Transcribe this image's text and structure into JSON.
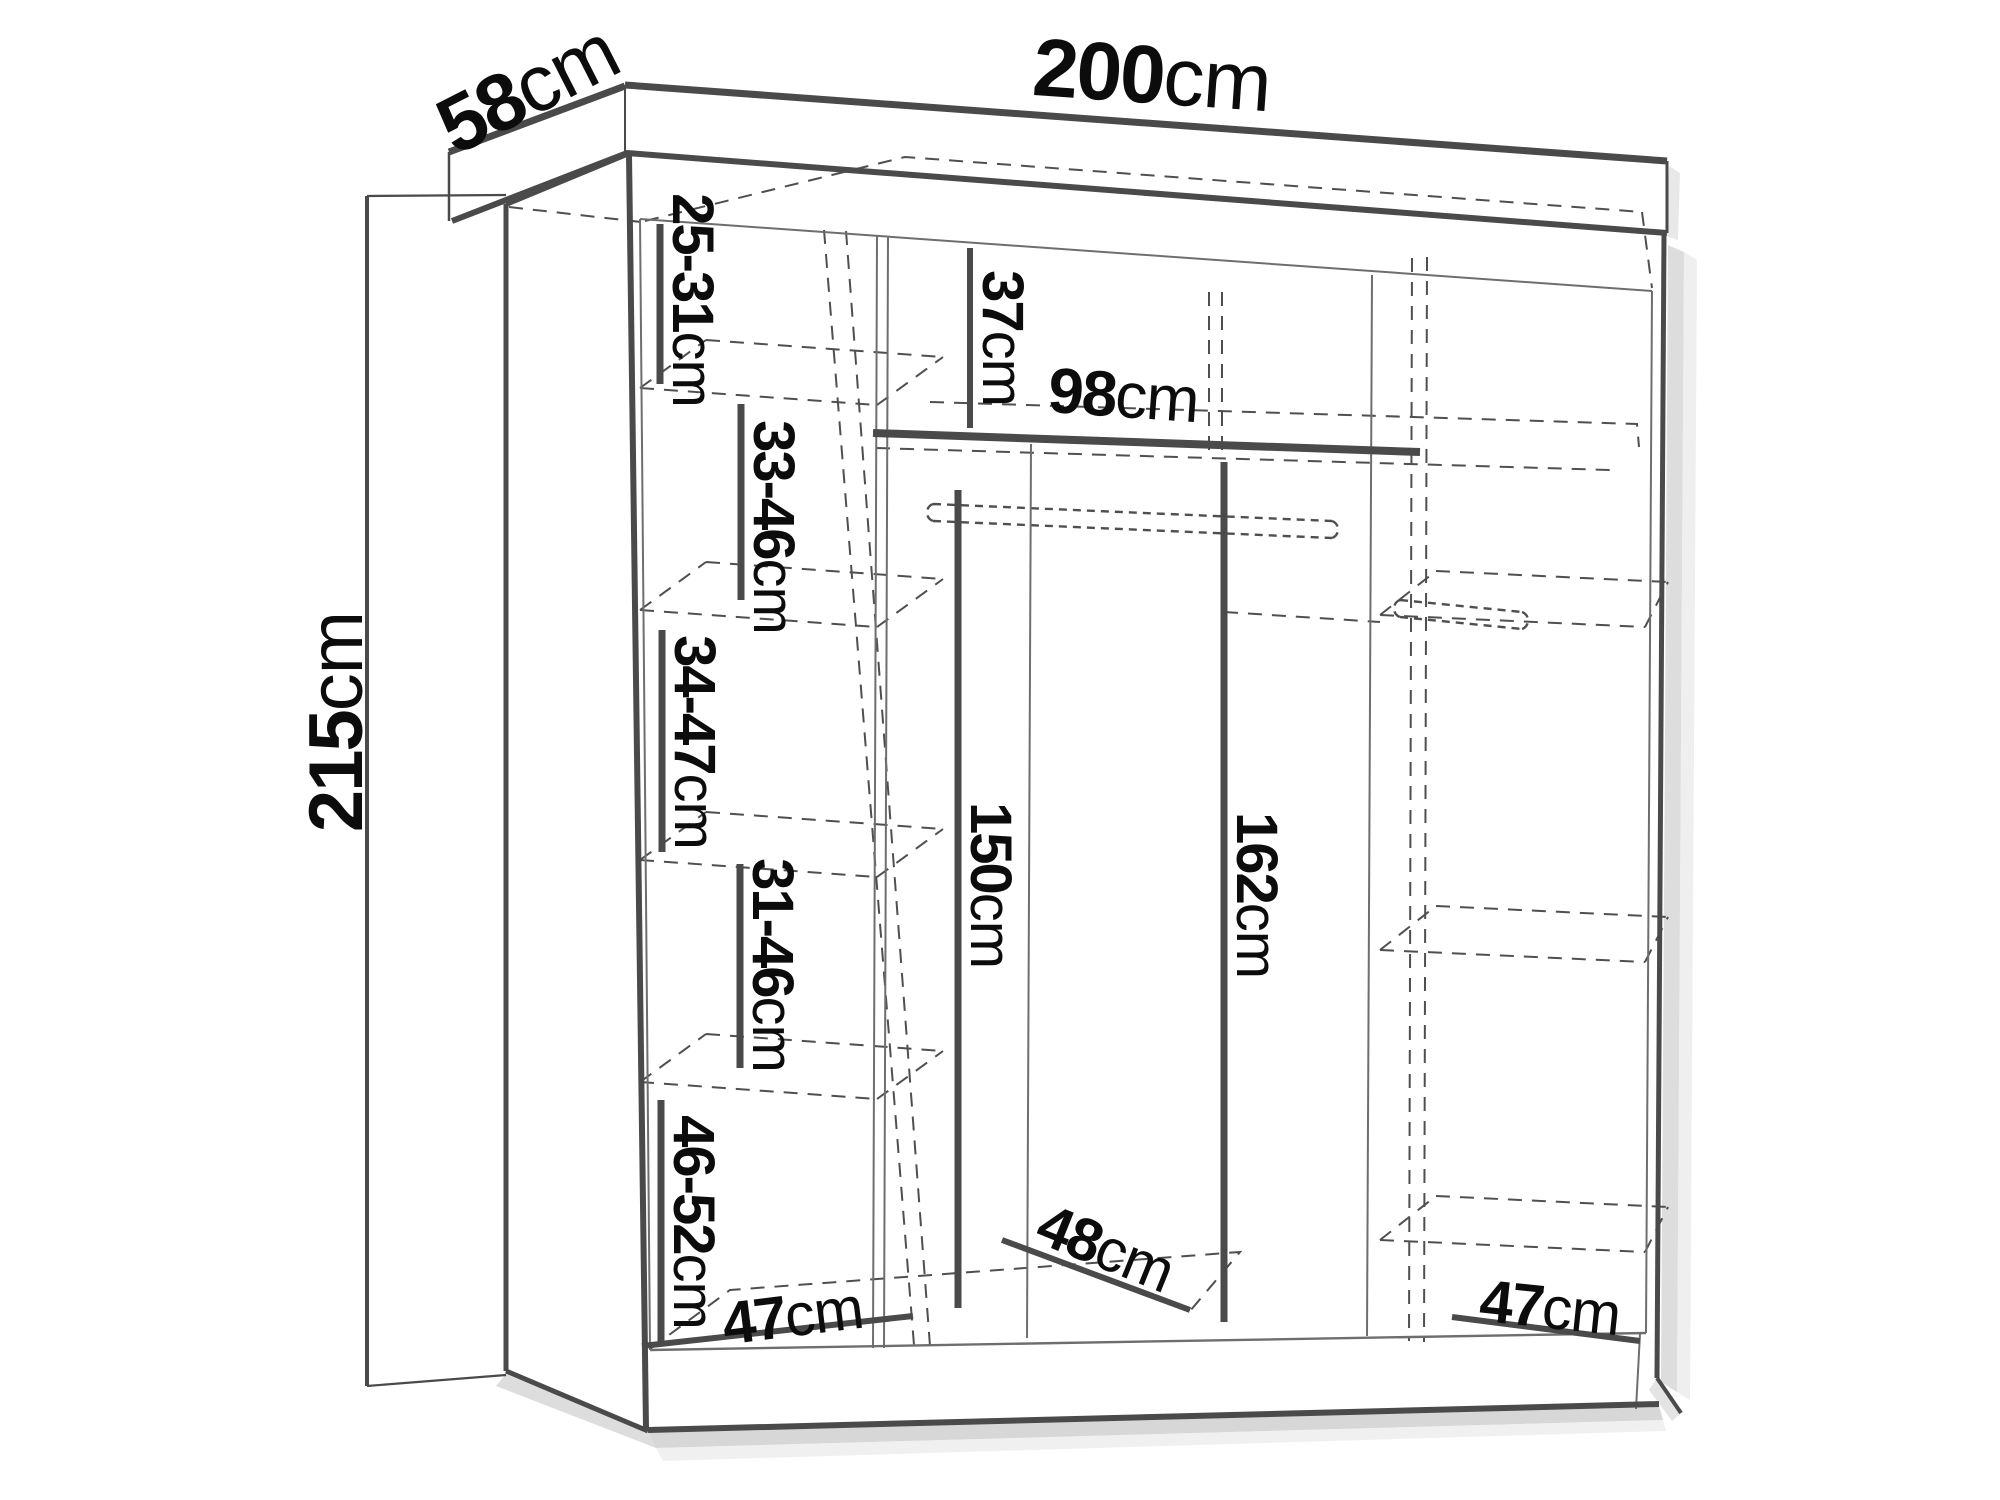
{
  "diagram": {
    "title": "wardrobe dimension diagram",
    "unit": "cm",
    "overall": {
      "width_cm": 200,
      "depth_cm": 58,
      "height_cm": 215
    },
    "labels": {
      "width": {
        "value": "200",
        "unit": "cm"
      },
      "depth": {
        "value": "58",
        "unit": "cm"
      },
      "height": {
        "value": "215",
        "unit": "cm"
      },
      "left_column_gaps": [
        {
          "value": "25-31",
          "unit": "cm"
        },
        {
          "value": "33-46",
          "unit": "cm"
        },
        {
          "value": "34-47",
          "unit": "cm"
        },
        {
          "value": "31-46",
          "unit": "cm"
        },
        {
          "value": "46-52",
          "unit": "cm"
        }
      ],
      "top_compartment_height": {
        "value": "37",
        "unit": "cm"
      },
      "middle_shelf_width": {
        "value": "98",
        "unit": "cm"
      },
      "hanging_height_middle": {
        "value": "150",
        "unit": "cm"
      },
      "hanging_height_right": {
        "value": "162",
        "unit": "cm"
      },
      "bottom_left_width": {
        "value": "47",
        "unit": "cm"
      },
      "bottom_middle_depth": {
        "value": "48",
        "unit": "cm"
      },
      "bottom_right_width": {
        "value": "47",
        "unit": "cm"
      }
    }
  }
}
